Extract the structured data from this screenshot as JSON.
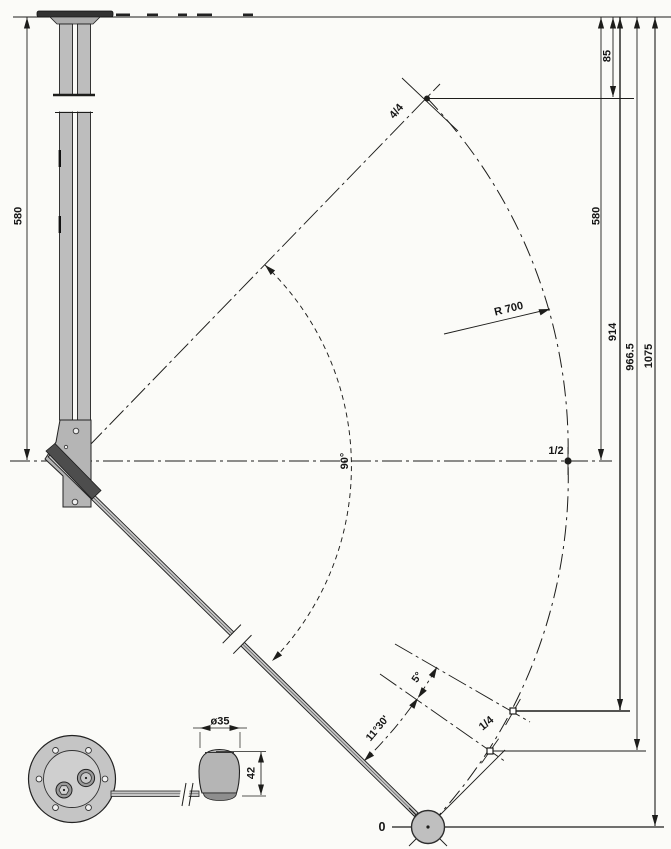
{
  "meta": {
    "description": "Technical dimension drawing of a ceiling-mounted swing lever with motion arc and detail view of base flange and knob",
    "background": "#fbfbf8",
    "ink": "#1d1d1b",
    "metal_fill": "#bdbdbd"
  },
  "labels": {
    "dim_left_580": "580",
    "dim_85": "85",
    "pos_4_4": "4/4",
    "dim_right_580": "580",
    "dim_914": "914",
    "dim_966_5": "966.5",
    "dim_1075": "1075",
    "radius": "R 700",
    "pos_1_2": "1/2",
    "angle_90": "90°",
    "angle_11_30": "11°30'",
    "angle_5": "5°",
    "pos_1_4": "1/4",
    "pos_0": "0",
    "dia_35": "ø35",
    "dim_42": "42"
  }
}
